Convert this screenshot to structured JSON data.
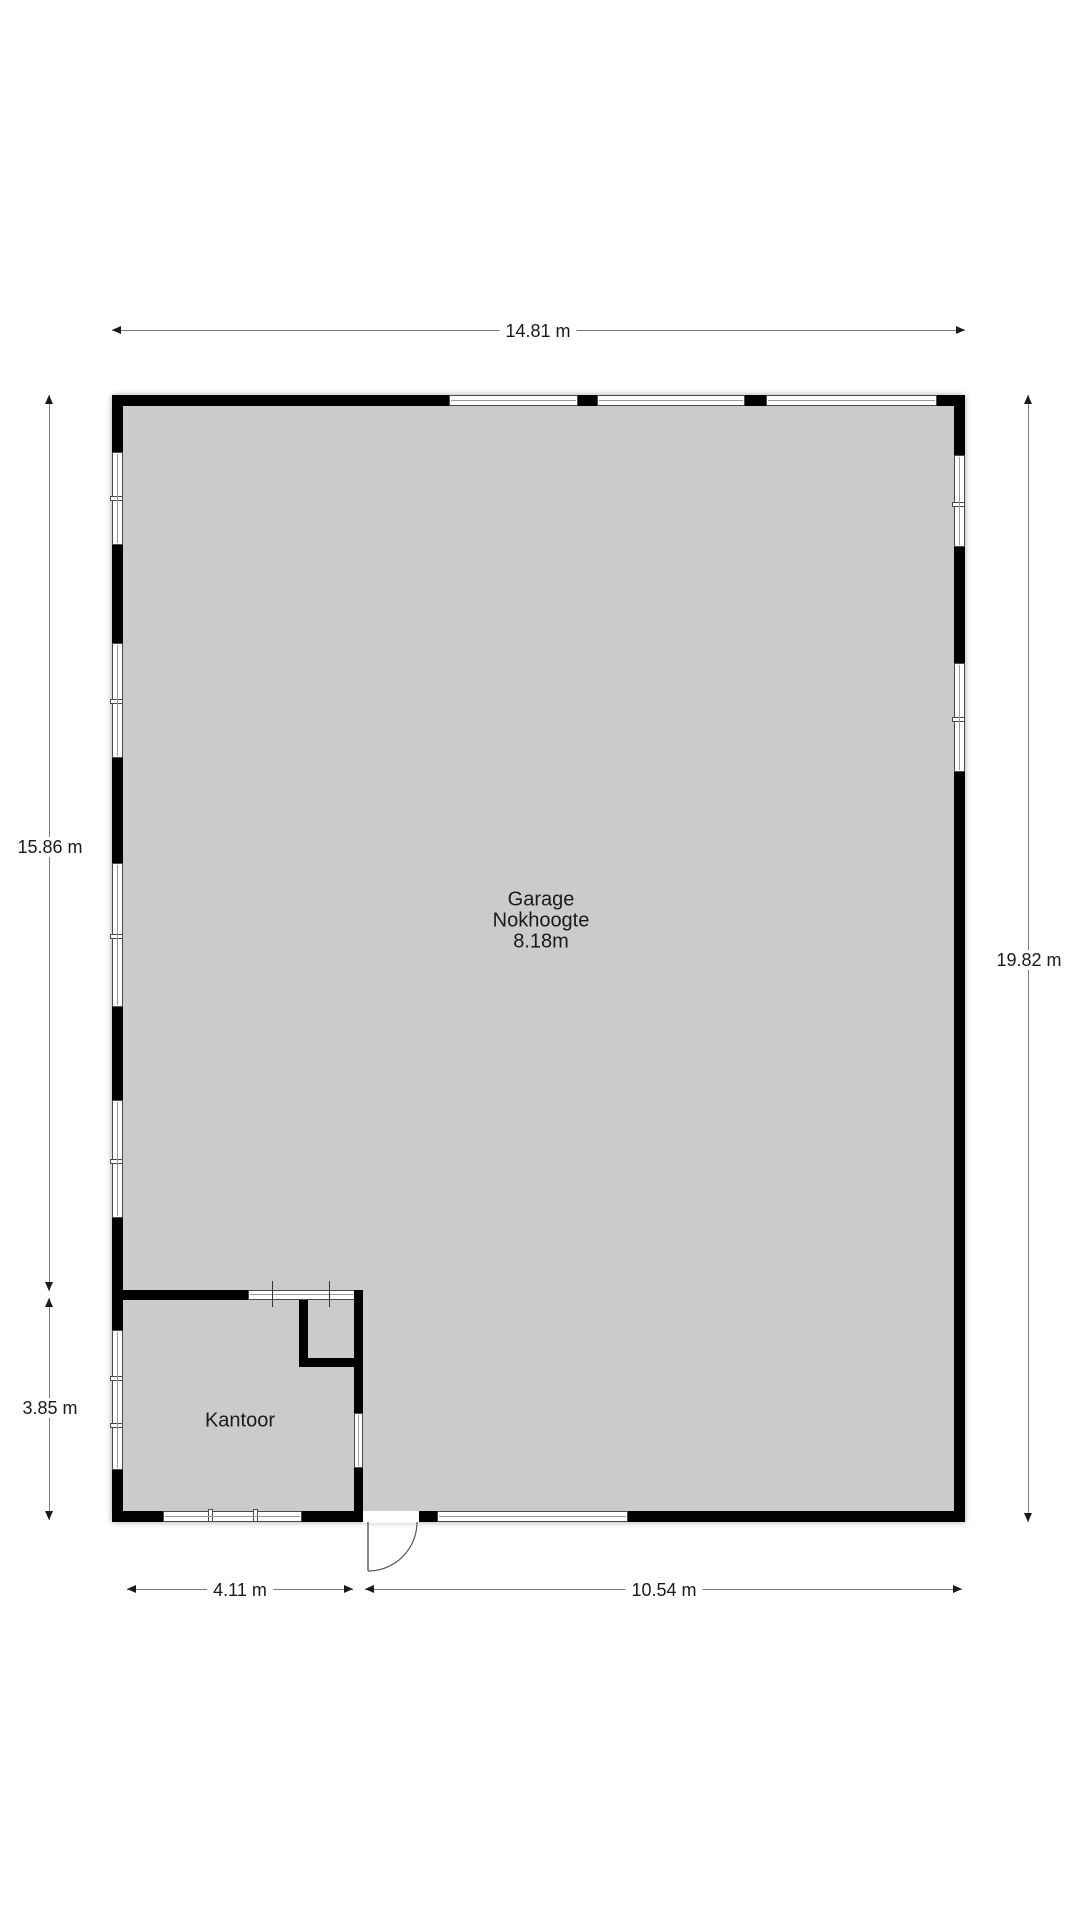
{
  "rooms": {
    "garage": {
      "name": "Garage",
      "attribute": "Nokhoogte",
      "ridge_height": "8.18m"
    },
    "kantoor": {
      "name": "Kantoor"
    }
  },
  "dimensions": {
    "top_width": "14.81 m",
    "left_upper_height": "15.86 m",
    "left_lower_height": "3.85 m",
    "right_height": "19.82 m",
    "bottom_left_width": "4.11 m",
    "bottom_right_width": "10.54 m"
  },
  "colors": {
    "floor": "#cbcbcb",
    "wall": "#000000",
    "window_frame": "#4a4a4a",
    "dimension_line": "#7b7b7b",
    "text": "#1a1a1a"
  }
}
